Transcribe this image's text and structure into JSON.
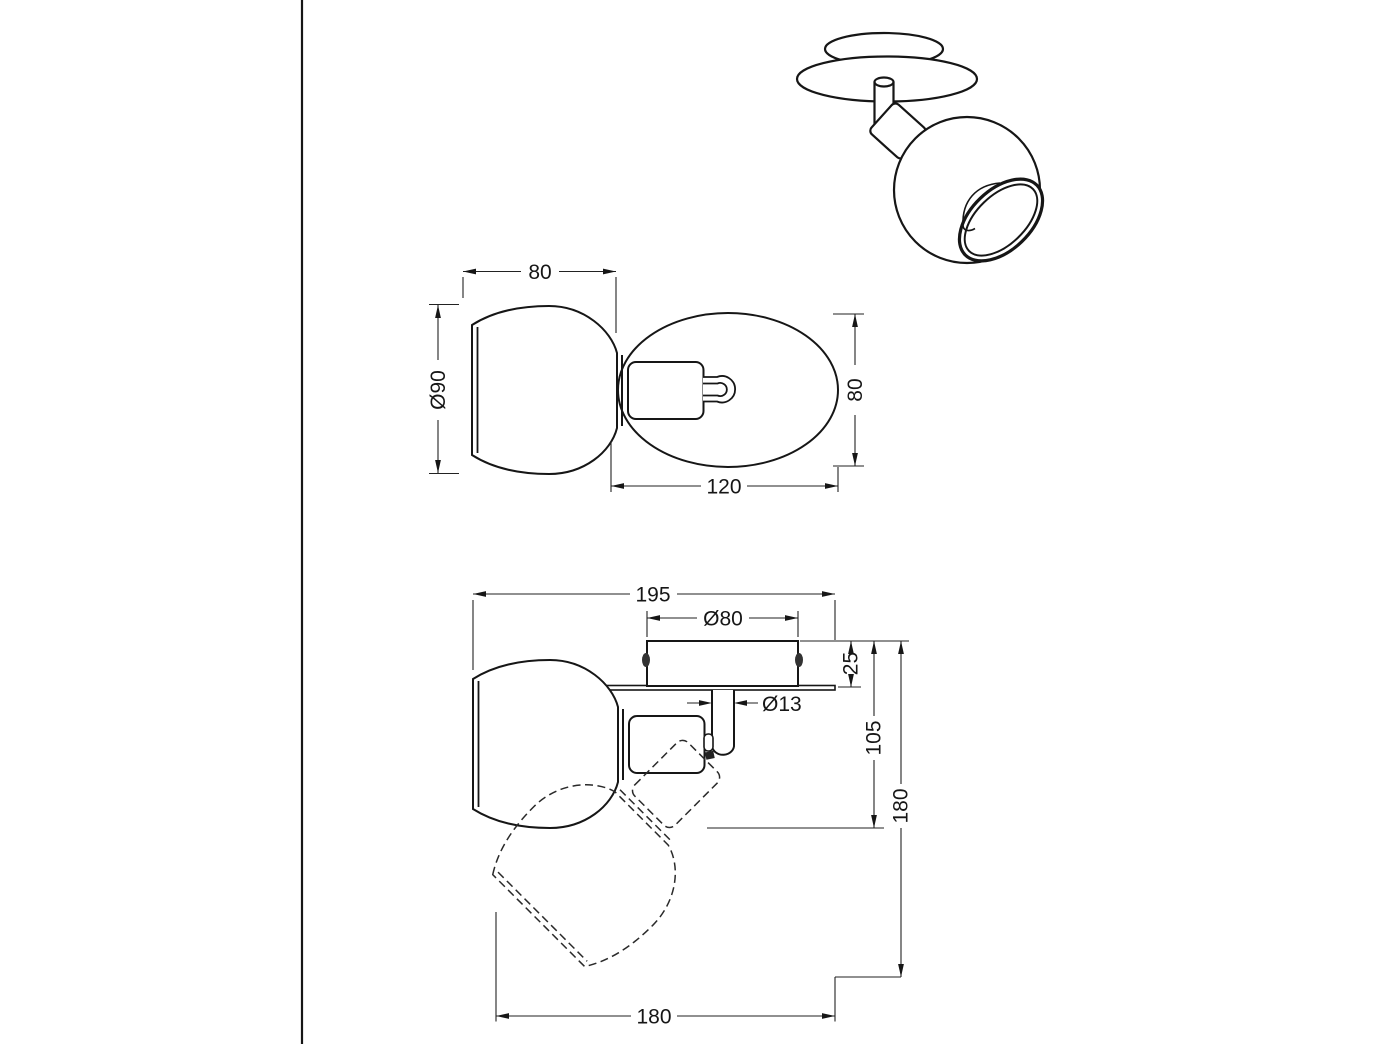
{
  "page": {
    "background": "#ffffff",
    "ink": "#161616",
    "screw_color": "#333333",
    "description": "Technical dimension drawing of an adjustable ball spotlight lamp: perspective view, top view and side view with swivel position shown dashed"
  },
  "dimensions": {
    "top_view": {
      "shade_width": "80",
      "shade_diameter": "Ø90",
      "plate_height": "80",
      "plate_length": "120"
    },
    "side_view": {
      "overall_width": "195",
      "canopy_diameter": "Ø80",
      "canopy_depth": "25",
      "stem_diameter": "Ø13",
      "depth_to_joint": "105",
      "overall_height": "180",
      "swivel_span": "180"
    }
  }
}
